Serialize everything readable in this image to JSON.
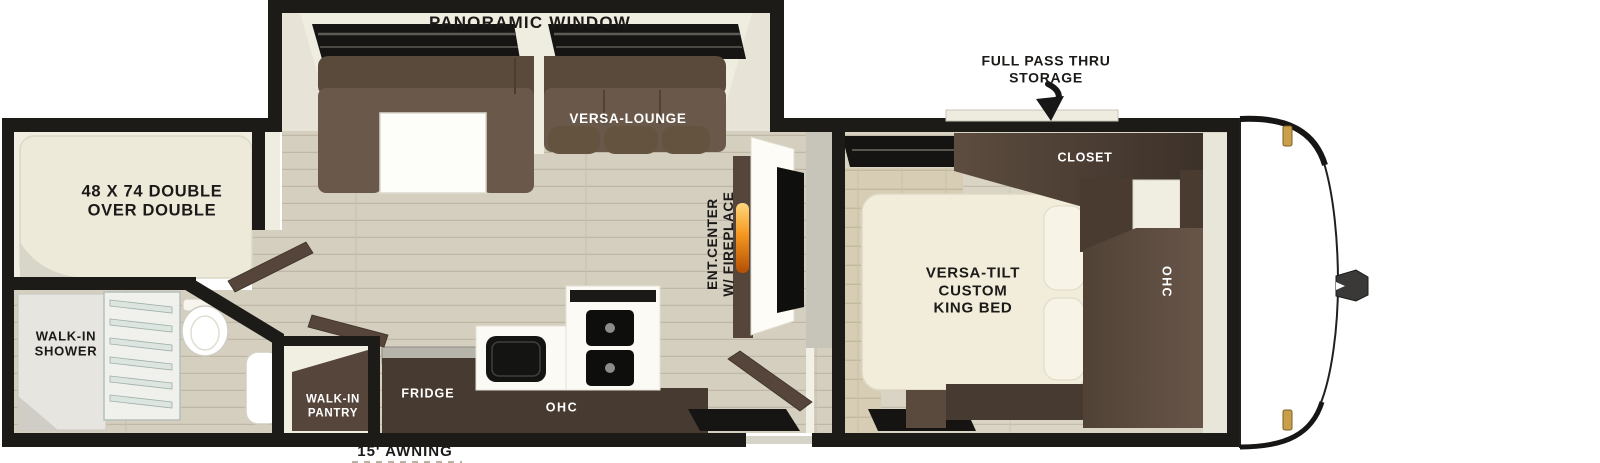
{
  "diagram": {
    "type": "rv-travel-trailer-floorplan",
    "labels": {
      "panoramic_window": "PANORAMIC WINDOW",
      "versa_lounge": "VERSA-LOUNGE",
      "full_pass_thru_storage": "FULL PASS THRU\nSTORAGE",
      "closet": "CLOSET",
      "bunk_bed": "48 X 74 DOUBLE\nOVER DOUBLE",
      "versa_tilt_king_bed": "VERSA-TILT\nCUSTOM\nKING BED",
      "ohc_bedroom": "OHC",
      "ent_center_fireplace": "ENT.CENTER\nW/ FIREPLACE",
      "walk_in_shower": "WALK-IN\nSHOWER",
      "walk_in_pantry": "WALK-IN\nPANTRY",
      "fridge": "FRIDGE",
      "ohc_kitchen": "OHC",
      "awning": "15' AWNING"
    },
    "colors": {
      "wall": "#1d1b18",
      "floor_wood": "#d5cfc0",
      "sofa": "#6a594a",
      "sofa_dark": "#5a4a3c",
      "wood_dark": "#473a30",
      "wood_mid": "#55453a",
      "bed_cream": "#f1edda",
      "bunk_cream": "#edead9",
      "flame_orange": "#f6971f",
      "marker_amber": "#c99f49"
    }
  }
}
